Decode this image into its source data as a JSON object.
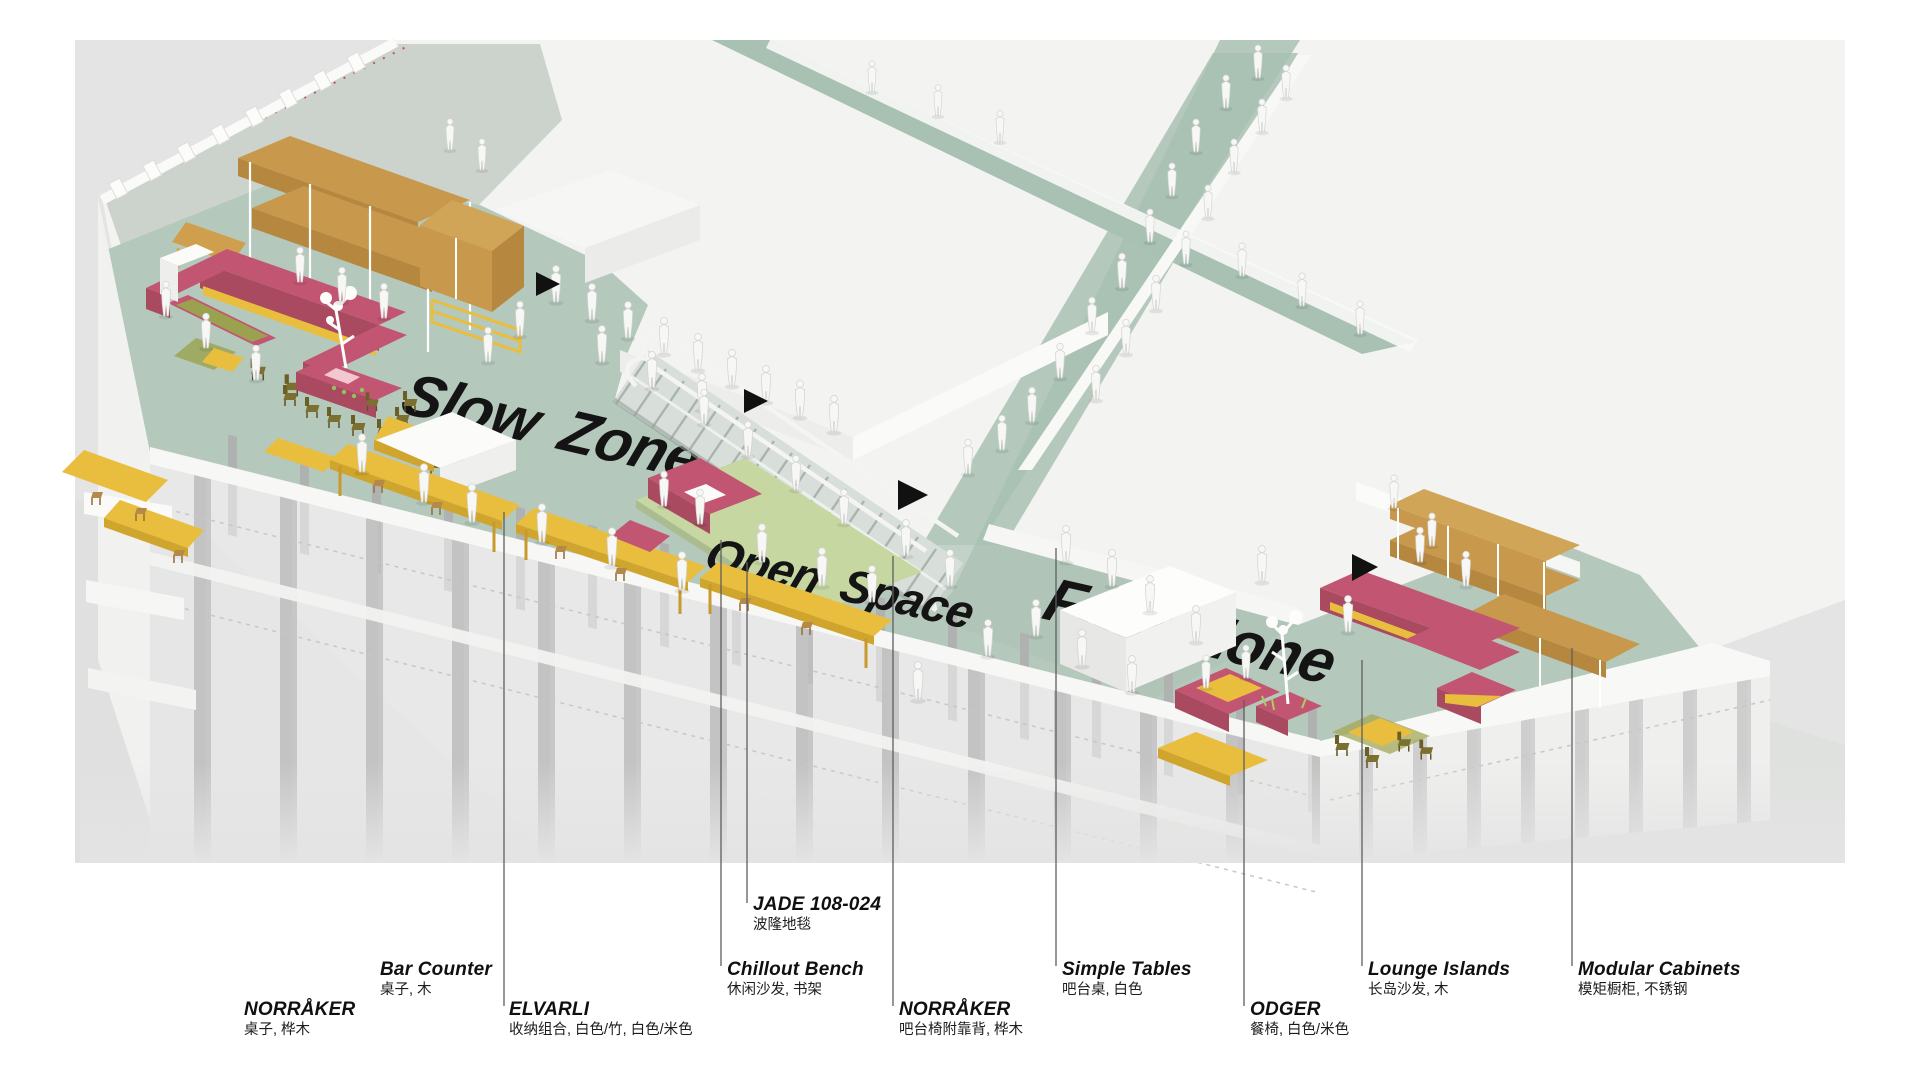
{
  "figure": {
    "type": "axonometric-interior-diagram",
    "description_visible_text_only": true
  },
  "zones": {
    "slow": "Slow Zone",
    "open": "Open Space",
    "fast": "Fast Zone"
  },
  "annotations": {
    "norraker_table": {
      "en": "NORRÅKER",
      "zh": "桌子, 桦木"
    },
    "bar_counter": {
      "en": "Bar Counter",
      "zh": "桌子, 木"
    },
    "elvarli": {
      "en": "ELVARLI",
      "zh": "收纳组合, 白色/竹, 白色/米色"
    },
    "jade": {
      "en": "JADE 108-024",
      "zh": "波隆地毯"
    },
    "chillout_bench": {
      "en": "Chillout Bench",
      "zh": "休闲沙发, 书架"
    },
    "norraker_stool": {
      "en": "NORRÅKER",
      "zh": "吧台椅附靠背, 桦木"
    },
    "simple_tables": {
      "en": "Simple Tables",
      "zh": "吧台桌, 白色"
    },
    "odger": {
      "en": "ODGER",
      "zh": "餐椅, 白色/米色"
    },
    "lounge_islands": {
      "en": "Lounge Islands",
      "zh": "长岛沙发, 木"
    },
    "modular_cabinets": {
      "en": "Modular Cabinets",
      "zh": "模矩橱柜, 不锈钢"
    }
  },
  "palette": {
    "canvas_gray": "#e3e4e3",
    "floor_sage": "#b5c8bc",
    "walkway_sage": "#a8c1b3",
    "rug_green": "#c6d7a2",
    "furniture_magenta": "#c25672",
    "furniture_yellow": "#e9be3e",
    "furniture_wood": "#c8994d",
    "chair_olive": "#7c7030",
    "zone_text": "#141414",
    "marker_black": "#111111",
    "dotted_red": "#c43d4f"
  }
}
